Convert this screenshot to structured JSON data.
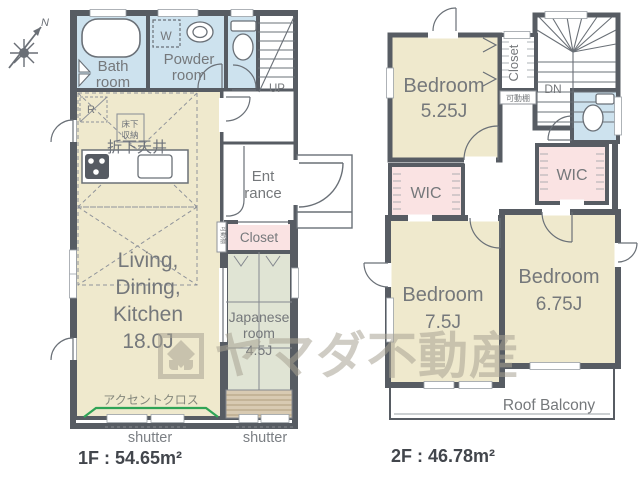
{
  "compass": {
    "label": "N"
  },
  "watermark": {
    "text": "ヤマダ不動産"
  },
  "floor1": {
    "area_label": "1F : 54.65m²",
    "bath": {
      "lines": [
        "Bath",
        "room"
      ]
    },
    "powder": {
      "lines": [
        "Powder",
        "room"
      ]
    },
    "washer_label": "W",
    "stairs_label": "UP",
    "entrance": {
      "lines": [
        "Ent",
        "rance"
      ]
    },
    "closet_label": "Closet",
    "shelf_label": "可動棚",
    "japanese": {
      "lines": [
        "Japanese",
        "room",
        "4.5J"
      ]
    },
    "ldk": {
      "lines": [
        "Living,",
        "Dining,",
        "Kitchen",
        "18.0J"
      ]
    },
    "dropped_ceiling_label": "折下天井",
    "underfloor": {
      "lines": [
        "床下",
        "収納"
      ]
    },
    "fridge_label": "R",
    "accent_label": "アクセントクロス",
    "shutter_label_1": "shutter",
    "shutter_label_2": "shutter"
  },
  "floor2": {
    "area_label": "2F : 46.78m²",
    "bedroom1": {
      "lines": [
        "Bedroom",
        "5.25J"
      ]
    },
    "bedroom2": {
      "lines": [
        "Bedroom",
        "7.5J"
      ]
    },
    "bedroom3": {
      "lines": [
        "Bedroom",
        "6.75J"
      ]
    },
    "closet_label": "Closet",
    "shelf_label": "可動棚",
    "wic1_label": "WIC",
    "wic2_label": "WIC",
    "stairs_label": "DN",
    "balcony_label": "Roof Balcony"
  },
  "colors": {
    "wall": "#575c63",
    "room_cream": "#efe9cd",
    "room_blue": "#cde2ee",
    "room_pink": "#fae3e3",
    "tatami": "#e0e4d4",
    "boards": "#d8cab2",
    "accent_green": "#2fa456",
    "watermark_gray": "#a9a494",
    "label_gray": "#75787b"
  },
  "icons": {
    "compass": "compass-rose-icon",
    "bathtub": "bathtub-icon",
    "toilet": "toilet-icon",
    "sink": "sink-icon",
    "stove": "stove-icon",
    "washer": "washing-machine-box"
  }
}
